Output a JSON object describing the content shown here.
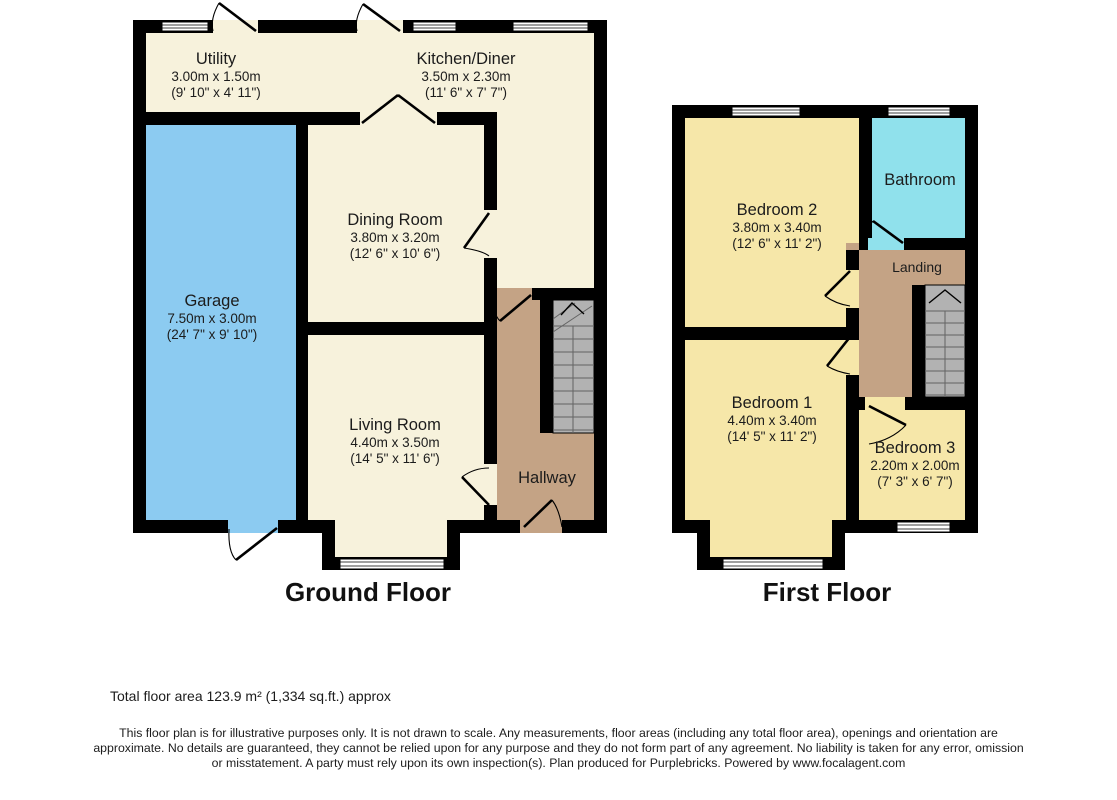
{
  "colors": {
    "wall": "#000000",
    "room_cream": "#F7F2DC",
    "garage_blue": "#8CCBF1",
    "bathroom_cyan": "#90E1EC",
    "bedroom_yellow": "#F6E7A9",
    "hall_tan": "#C4A385",
    "stairs_grey": "#B2B2B2"
  },
  "ground_floor": {
    "title": "Ground Floor",
    "rooms": {
      "utility": {
        "name": "Utility",
        "metric": "3.00m x 1.50m",
        "imperial": "(9' 10\" x 4' 11\")"
      },
      "kitchen_diner": {
        "name": "Kitchen/Diner",
        "metric": "3.50m x 2.30m",
        "imperial": "(11' 6\" x 7' 7\")"
      },
      "dining_room": {
        "name": "Dining Room",
        "metric": "3.80m x 3.20m",
        "imperial": "(12' 6\" x 10' 6\")"
      },
      "garage": {
        "name": "Garage",
        "metric": "7.50m x 3.00m",
        "imperial": "(24' 7\" x 9' 10\")"
      },
      "living_room": {
        "name": "Living Room",
        "metric": "4.40m x 3.50m",
        "imperial": "(14' 5\" x 11' 6\")"
      },
      "hallway": {
        "name": "Hallway"
      }
    }
  },
  "first_floor": {
    "title": "First Floor",
    "rooms": {
      "bedroom2": {
        "name": "Bedroom 2",
        "metric": "3.80m x 3.40m",
        "imperial": "(12' 6\" x 11' 2\")"
      },
      "bathroom": {
        "name": "Bathroom"
      },
      "landing": {
        "name": "Landing"
      },
      "bedroom1": {
        "name": "Bedroom 1",
        "metric": "4.40m x 3.40m",
        "imperial": "(14' 5\" x 11' 2\")"
      },
      "bedroom3": {
        "name": "Bedroom 3",
        "metric": "2.20m x 2.00m",
        "imperial": "(7' 3\" x 6' 7\")"
      }
    }
  },
  "footer": {
    "total_area": "Total floor area 123.9 m² (1,334 sq.ft.) approx",
    "disclaimer_line1": "This floor plan is for illustrative purposes only. It is not drawn to scale. Any measurements, floor areas (including any total floor area), openings and orientation are",
    "disclaimer_line2": "approximate. No details are guaranteed, they cannot be relied upon for any purpose and they do not form part of any agreement. No liability is taken for any error, omission",
    "disclaimer_line3": "or misstatement. A party must rely upon its own inspection(s). Plan produced for Purplebricks. Powered by www.focalagent.com"
  }
}
